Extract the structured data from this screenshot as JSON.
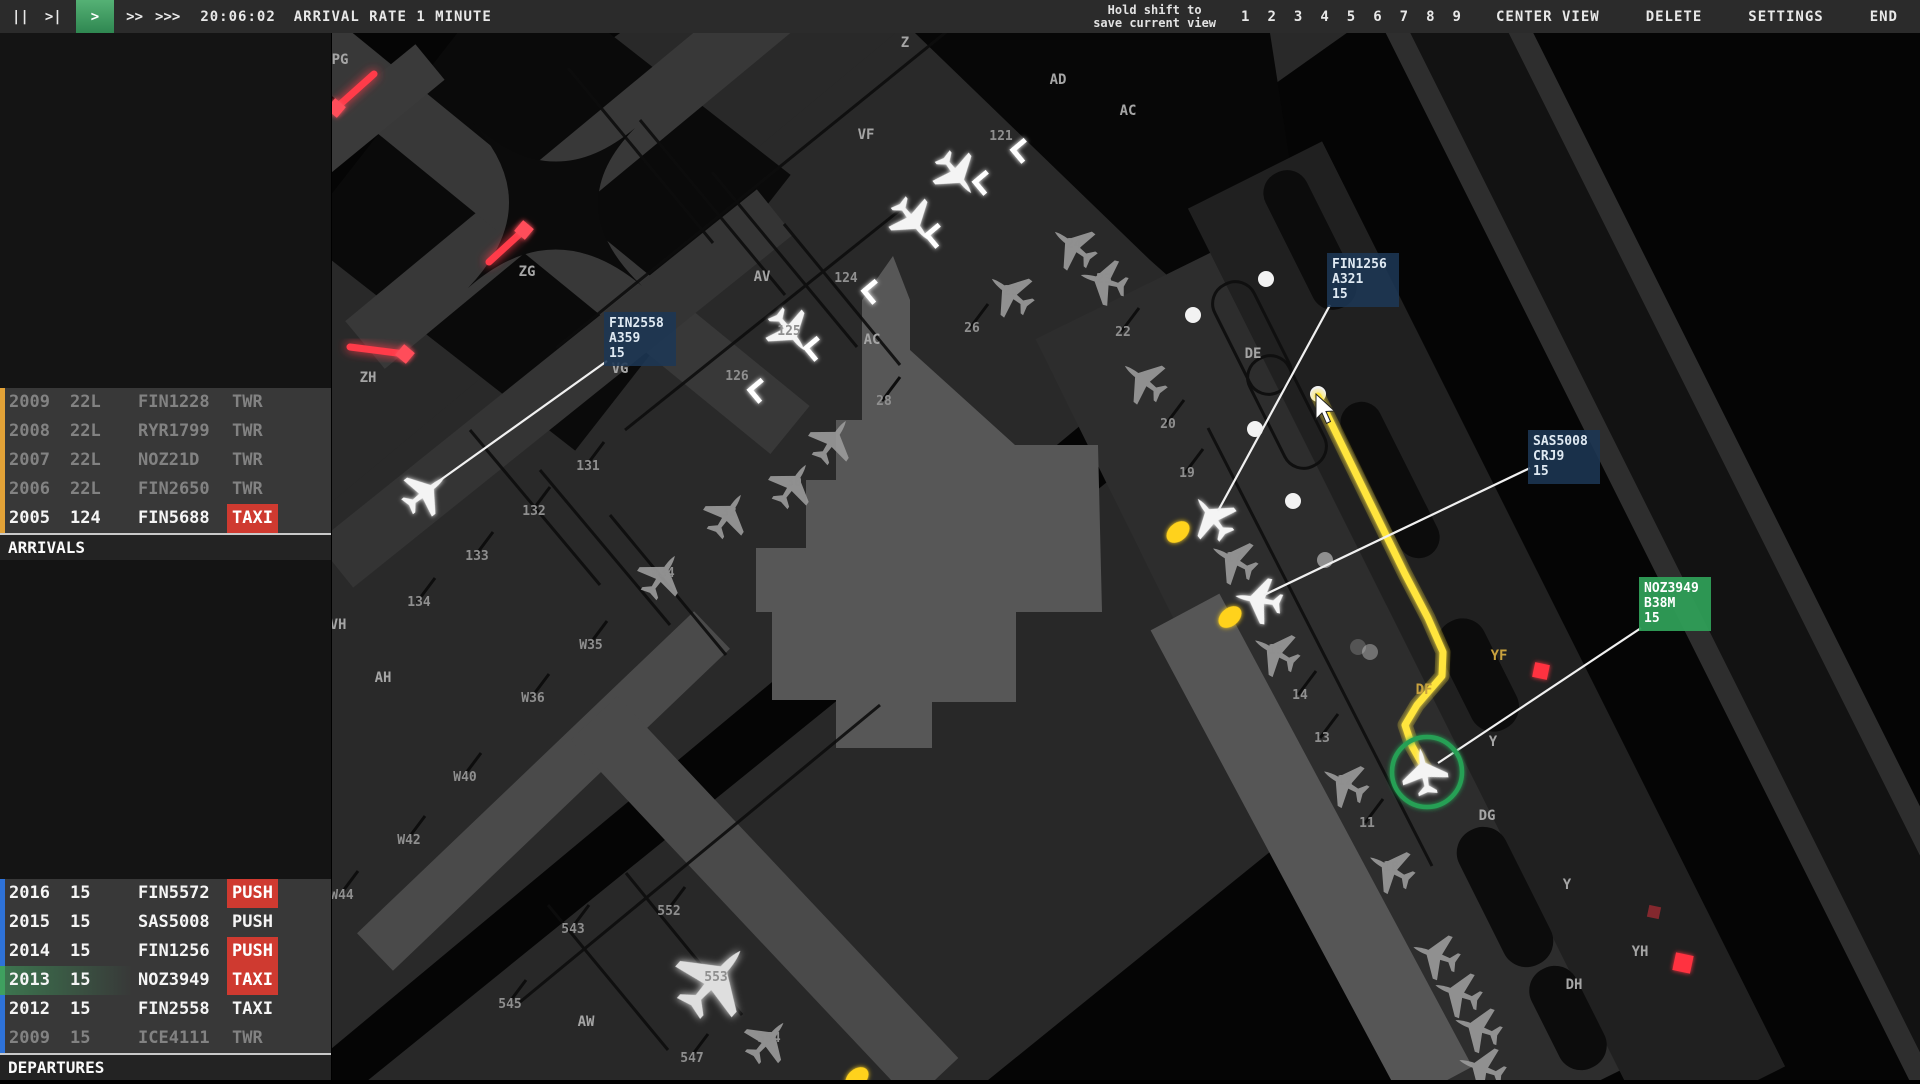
{
  "top_bar": {
    "pause": "||",
    "step": ">|",
    "play": ">",
    "ff": ">>",
    "fff": ">>>",
    "clock": "20:06:02",
    "arrival_rate": "ARRIVAL RATE 1 MINUTE",
    "hint_line1": "Hold shift to",
    "hint_line2": "save current view",
    "view_slots": [
      "1",
      "2",
      "3",
      "4",
      "5",
      "6",
      "7",
      "8",
      "9"
    ],
    "center_view": "CENTER VIEW",
    "delete_label": "DELETE",
    "settings_label": "SETTINGS",
    "end_label": "END"
  },
  "arrivals": {
    "header": "ARRIVALS",
    "rows": [
      {
        "time": "2009",
        "rwy": "22L",
        "callsign": "FIN1228",
        "status": "TWR",
        "dim": true,
        "badge": false,
        "bar": "orange"
      },
      {
        "time": "2008",
        "rwy": "22L",
        "callsign": "RYR1799",
        "status": "TWR",
        "dim": true,
        "badge": false,
        "bar": "orange"
      },
      {
        "time": "2007",
        "rwy": "22L",
        "callsign": "NOZ21D",
        "status": "TWR",
        "dim": true,
        "badge": false,
        "bar": "orange"
      },
      {
        "time": "2006",
        "rwy": "22L",
        "callsign": "FIN2650",
        "status": "TWR",
        "dim": true,
        "badge": false,
        "bar": "orange"
      },
      {
        "time": "2005",
        "rwy": "124",
        "callsign": "FIN5688",
        "status": "TAXI",
        "dim": false,
        "badge": true,
        "bar": "orange"
      }
    ]
  },
  "departures": {
    "header": "DEPARTURES",
    "rows": [
      {
        "time": "2016",
        "rwy": "15",
        "callsign": "FIN5572",
        "status": "PUSH",
        "dim": false,
        "badge": true,
        "bar": "blue"
      },
      {
        "time": "2015",
        "rwy": "15",
        "callsign": "SAS5008",
        "status": "PUSH",
        "dim": false,
        "badge": false,
        "bar": "blue"
      },
      {
        "time": "2014",
        "rwy": "15",
        "callsign": "FIN1256",
        "status": "PUSH",
        "dim": false,
        "badge": true,
        "bar": "blue"
      },
      {
        "time": "2013",
        "rwy": "15",
        "callsign": "NOZ3949",
        "status": "TAXI",
        "dim": false,
        "badge": true,
        "bar": "green"
      },
      {
        "time": "2012",
        "rwy": "15",
        "callsign": "FIN2558",
        "status": "TAXI",
        "dim": false,
        "badge": false,
        "bar": "blue"
      },
      {
        "time": "2009",
        "rwy": "15",
        "callsign": "ICE4111",
        "status": "TWR",
        "dim": true,
        "badge": false,
        "bar": "blue"
      }
    ]
  },
  "colors": {
    "topbar_bg": "#2b2b2b",
    "accent_green": "#3da05c",
    "strip_badge_red": "#cf3a30",
    "bar_orange": "#e2a237",
    "bar_blue": "#2e72d8",
    "bar_green": "#3fa05f",
    "route_yellow": "#ffe53e",
    "stopbar_red": "#ff3b4a",
    "tag_blue": "#1c3754",
    "tag_green": "#2f9e57"
  },
  "map": {
    "aircraft_tags": [
      {
        "callsign": "FIN2558",
        "type": "A359",
        "rwy": "15",
        "x": 604,
        "y": 312,
        "style": "blue",
        "leader": [
          432,
          486,
          607,
          361
        ]
      },
      {
        "callsign": "FIN1256",
        "type": "A321",
        "rwy": "15",
        "x": 1327,
        "y": 253,
        "style": "blue",
        "leader": [
          1218,
          511,
          1330,
          305
        ]
      },
      {
        "callsign": "SAS5008",
        "type": "CRJ9",
        "rwy": "15",
        "x": 1528,
        "y": 430,
        "style": "blue",
        "leader": [
          1264,
          595,
          1530,
          468
        ]
      },
      {
        "callsign": "NOZ3949",
        "type": "B38M",
        "rwy": "15",
        "x": 1639,
        "y": 577,
        "style": "green",
        "leader": [
          1438,
          763,
          1641,
          628
        ]
      }
    ],
    "taxi_labels": [
      {
        "t": "PG",
        "x": 340,
        "y": 64
      },
      {
        "t": "Z",
        "x": 905,
        "y": 47
      },
      {
        "t": "ZG",
        "x": 527,
        "y": 276
      },
      {
        "t": "ZH",
        "x": 368,
        "y": 382
      },
      {
        "t": "VF",
        "x": 866,
        "y": 139
      },
      {
        "t": "VG",
        "x": 620,
        "y": 373
      },
      {
        "t": "AV",
        "x": 762,
        "y": 281
      },
      {
        "t": "AD",
        "x": 1058,
        "y": 84
      },
      {
        "t": "AC",
        "x": 1128,
        "y": 115
      },
      {
        "t": "AC",
        "x": 872,
        "y": 344
      },
      {
        "t": "AH",
        "x": 383,
        "y": 682
      },
      {
        "t": "AW",
        "x": 586,
        "y": 1026
      },
      {
        "t": "VH",
        "x": 338,
        "y": 629
      },
      {
        "t": "DE",
        "x": 1253,
        "y": 358
      },
      {
        "t": "DG",
        "x": 1487,
        "y": 820
      },
      {
        "t": "DH",
        "x": 1574,
        "y": 989
      },
      {
        "t": "Y",
        "x": 1493,
        "y": 746
      },
      {
        "t": "Y",
        "x": 1567,
        "y": 889
      },
      {
        "t": "YH",
        "x": 1640,
        "y": 956
      },
      {
        "t": "YF",
        "x": 1499,
        "y": 660,
        "c": "#c9a23e"
      },
      {
        "t": "DF",
        "x": 1424,
        "y": 694,
        "c": "#c9a23e"
      }
    ],
    "stand_labels": [
      {
        "t": "121",
        "x": 1001,
        "y": 140
      },
      {
        "t": "124",
        "x": 846,
        "y": 282
      },
      {
        "t": "125",
        "x": 789,
        "y": 335
      },
      {
        "t": "126",
        "x": 737,
        "y": 380
      },
      {
        "t": "22",
        "x": 1123,
        "y": 336,
        "st": 1
      },
      {
        "t": "23",
        "x": 1104,
        "y": 283
      },
      {
        "t": "24",
        "x": 1074,
        "y": 248
      },
      {
        "t": "25",
        "x": 1011,
        "y": 295
      },
      {
        "t": "26",
        "x": 972,
        "y": 332,
        "st": 1
      },
      {
        "t": "28",
        "x": 884,
        "y": 405,
        "st": 1
      },
      {
        "t": "20",
        "x": 1168,
        "y": 428,
        "st": 1
      },
      {
        "t": "19",
        "x": 1187,
        "y": 477,
        "st": 1
      },
      {
        "t": "131",
        "x": 588,
        "y": 470,
        "st": 1
      },
      {
        "t": "132",
        "x": 534,
        "y": 515,
        "st": 1
      },
      {
        "t": "133",
        "x": 477,
        "y": 560,
        "st": 1
      },
      {
        "t": "134",
        "x": 419,
        "y": 606,
        "st": 1
      },
      {
        "t": "W35",
        "x": 591,
        "y": 649,
        "st": 1
      },
      {
        "t": "W36",
        "x": 533,
        "y": 702,
        "st": 1
      },
      {
        "t": "W40",
        "x": 465,
        "y": 781,
        "st": 1
      },
      {
        "t": "W42",
        "x": 409,
        "y": 844,
        "st": 1
      },
      {
        "t": "W44",
        "x": 342,
        "y": 899,
        "st": 1
      },
      {
        "t": "543",
        "x": 573,
        "y": 933,
        "st": 1
      },
      {
        "t": "545",
        "x": 510,
        "y": 1008,
        "st": 1
      },
      {
        "t": "547",
        "x": 692,
        "y": 1062,
        "st": 1
      },
      {
        "t": "552",
        "x": 669,
        "y": 915,
        "st": 1
      },
      {
        "t": "553",
        "x": 716,
        "y": 981
      },
      {
        "t": "554",
        "x": 769,
        "y": 1042
      },
      {
        "t": "30",
        "x": 794,
        "y": 486
      },
      {
        "t": "32",
        "x": 729,
        "y": 516
      },
      {
        "t": "W34",
        "x": 663,
        "y": 577
      },
      {
        "t": "14",
        "x": 1300,
        "y": 699,
        "st": 1
      },
      {
        "t": "13",
        "x": 1322,
        "y": 742,
        "st": 1
      },
      {
        "t": "12",
        "x": 1345,
        "y": 785
      },
      {
        "t": "11",
        "x": 1367,
        "y": 827,
        "st": 1
      },
      {
        "t": "10",
        "x": 1391,
        "y": 871
      },
      {
        "t": "15",
        "x": 1276,
        "y": 654
      },
      {
        "t": "17",
        "x": 1234,
        "y": 562
      }
    ],
    "planes": [
      {
        "x": 957,
        "y": 175,
        "r": 142,
        "v": "bright"
      },
      {
        "x": 913,
        "y": 221,
        "r": 142,
        "v": "bright"
      },
      {
        "x": 790,
        "y": 332,
        "r": 142,
        "v": "bright"
      },
      {
        "x": 1073,
        "y": 246,
        "r": -52,
        "v": "gray"
      },
      {
        "x": 1010,
        "y": 293,
        "r": -52,
        "v": "gray"
      },
      {
        "x": 1103,
        "y": 281,
        "r": -75,
        "v": "gray"
      },
      {
        "x": 1143,
        "y": 380,
        "r": -52,
        "v": "gray"
      },
      {
        "x": 833,
        "y": 440,
        "r": 34,
        "v": "gray"
      },
      {
        "x": 793,
        "y": 484,
        "r": 34,
        "v": "gray"
      },
      {
        "x": 728,
        "y": 514,
        "r": 34,
        "v": "gray"
      },
      {
        "x": 662,
        "y": 575,
        "r": 34,
        "v": "gray"
      },
      {
        "x": 426,
        "y": 492,
        "r": 52,
        "v": "bright"
      },
      {
        "x": 1212,
        "y": 517,
        "r": -38,
        "v": "bright"
      },
      {
        "x": 1233,
        "y": 560,
        "r": -60,
        "v": "gray"
      },
      {
        "x": 1258,
        "y": 600,
        "r": -80,
        "v": "bright"
      },
      {
        "x": 1275,
        "y": 652,
        "r": -60,
        "v": "gray"
      },
      {
        "x": 1344,
        "y": 783,
        "r": -60,
        "v": "gray"
      },
      {
        "x": 1390,
        "y": 869,
        "r": -60,
        "v": "gray"
      },
      {
        "x": 1424,
        "y": 771,
        "r": -10,
        "v": "bright"
      },
      {
        "x": 1435,
        "y": 955,
        "r": -70,
        "v": "gray"
      },
      {
        "x": 1457,
        "y": 993,
        "r": -70,
        "v": "gray"
      },
      {
        "x": 1477,
        "y": 1028,
        "r": -70,
        "v": "gray"
      },
      {
        "x": 1481,
        "y": 1068,
        "r": -70,
        "v": "gray"
      },
      {
        "x": 715,
        "y": 979,
        "r": 42,
        "s": 1.65,
        "v": "bright2"
      },
      {
        "x": 768,
        "y": 1040,
        "r": 42,
        "v": "gray"
      }
    ],
    "corner_markers": [
      {
        "x": 1013,
        "y": 150
      },
      {
        "x": 975,
        "y": 182
      },
      {
        "x": 927,
        "y": 235
      },
      {
        "x": 864,
        "y": 291
      },
      {
        "x": 806,
        "y": 348
      },
      {
        "x": 750,
        "y": 390
      }
    ],
    "dots": [
      {
        "x": 1266,
        "y": 279,
        "o": 1
      },
      {
        "x": 1193,
        "y": 315,
        "o": 1
      },
      {
        "x": 1255,
        "y": 429,
        "o": 1
      },
      {
        "x": 1293,
        "y": 501,
        "o": 1
      },
      {
        "x": 1318,
        "y": 394,
        "o": 1
      },
      {
        "x": 1325,
        "y": 560,
        "o": 0.5
      },
      {
        "x": 1370,
        "y": 652,
        "o": 0.35
      },
      {
        "x": 1358,
        "y": 647,
        "o": 0.2
      }
    ],
    "tugs": [
      {
        "x": 1178,
        "y": 532
      },
      {
        "x": 1230,
        "y": 617
      },
      {
        "x": 857,
        "y": 1078
      }
    ],
    "stopbars": [
      {
        "x1": 336,
        "y1": 108,
        "x2": 374,
        "y2": 74,
        "dx": 336,
        "dy": 108
      },
      {
        "x1": 489,
        "y1": 262,
        "x2": 524,
        "y2": 230,
        "dx": 524,
        "dy": 230
      },
      {
        "x1": 350,
        "y1": 347,
        "x2": 405,
        "y2": 354,
        "dx": 405,
        "dy": 354
      }
    ],
    "red_squares": [
      {
        "x": 1541,
        "y": 671,
        "s": 15,
        "o": 1
      },
      {
        "x": 1654,
        "y": 912,
        "s": 12,
        "o": 0.45
      },
      {
        "x": 1683,
        "y": 963,
        "s": 18,
        "o": 1
      }
    ],
    "route": [
      [
        1318,
        396
      ],
      [
        1405,
        574
      ],
      [
        1428,
        618
      ],
      [
        1443,
        652
      ],
      [
        1442,
        676
      ],
      [
        1417,
        705
      ],
      [
        1405,
        725
      ],
      [
        1412,
        746
      ],
      [
        1421,
        762
      ],
      [
        1426,
        770
      ]
    ],
    "selection": {
      "x": 1427,
      "y": 772,
      "r": 35
    },
    "cursor": {
      "x": 1316,
      "y": 394
    }
  }
}
